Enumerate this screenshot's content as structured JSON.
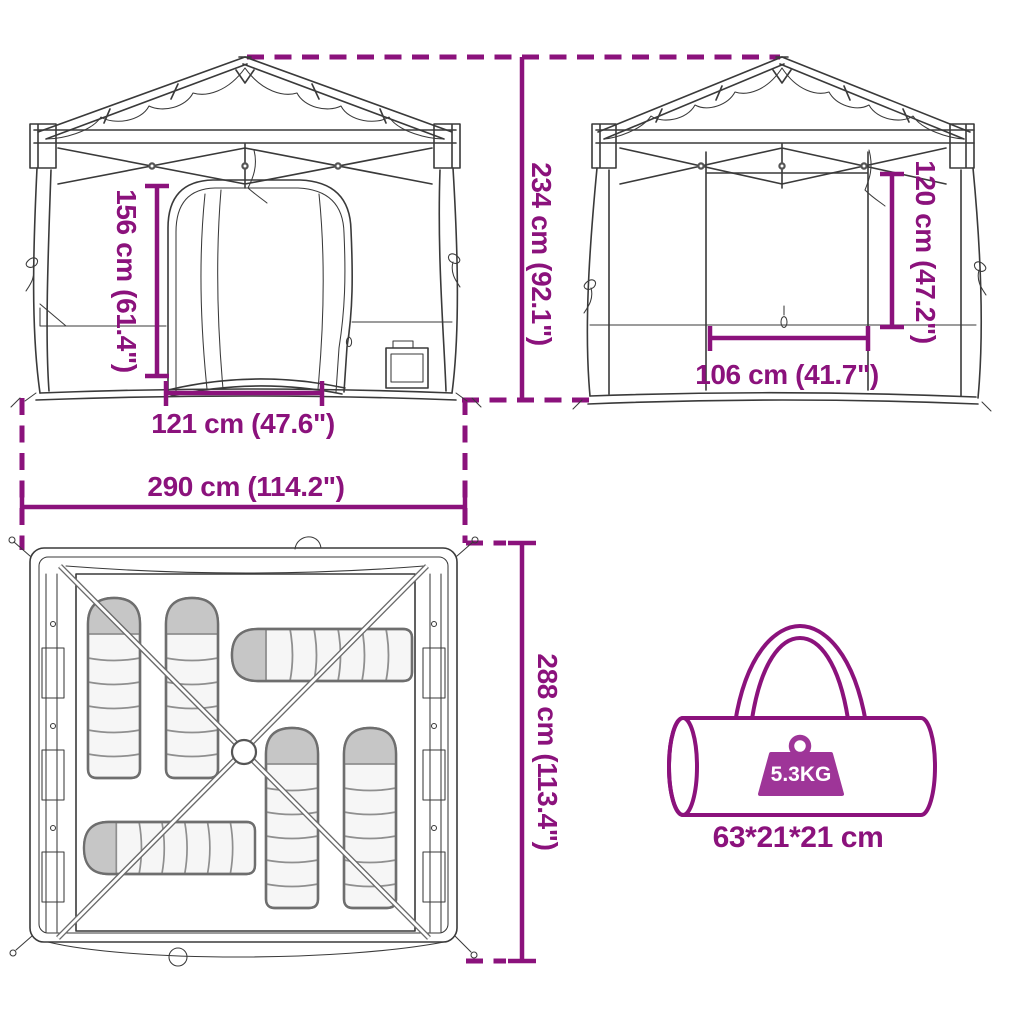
{
  "title": "Pop-up tent dimensions diagram",
  "accent_color": "#8B127C",
  "weight_badge_color": "#9E3598",
  "labels": {
    "door_height": "156 cm (61.4\")",
    "door_width": "121 cm (47.6\")",
    "tent_width": "290 cm (114.2\")",
    "tent_height": "234 cm (92.1\")",
    "window_height": "120 cm (47.2\")",
    "window_width": "106 cm (41.7\")",
    "tent_depth": "288 cm (113.4\")",
    "bag_weight": "5.3KG",
    "bag_size": "63*21*21 cm"
  },
  "icons": {
    "weight_icon": "trapezoid-weight-with-ring",
    "carry_bag_icon": "cylindrical-duffel-with-handle",
    "sleeping_bag_icon": "mummy-sleeping-bag"
  }
}
